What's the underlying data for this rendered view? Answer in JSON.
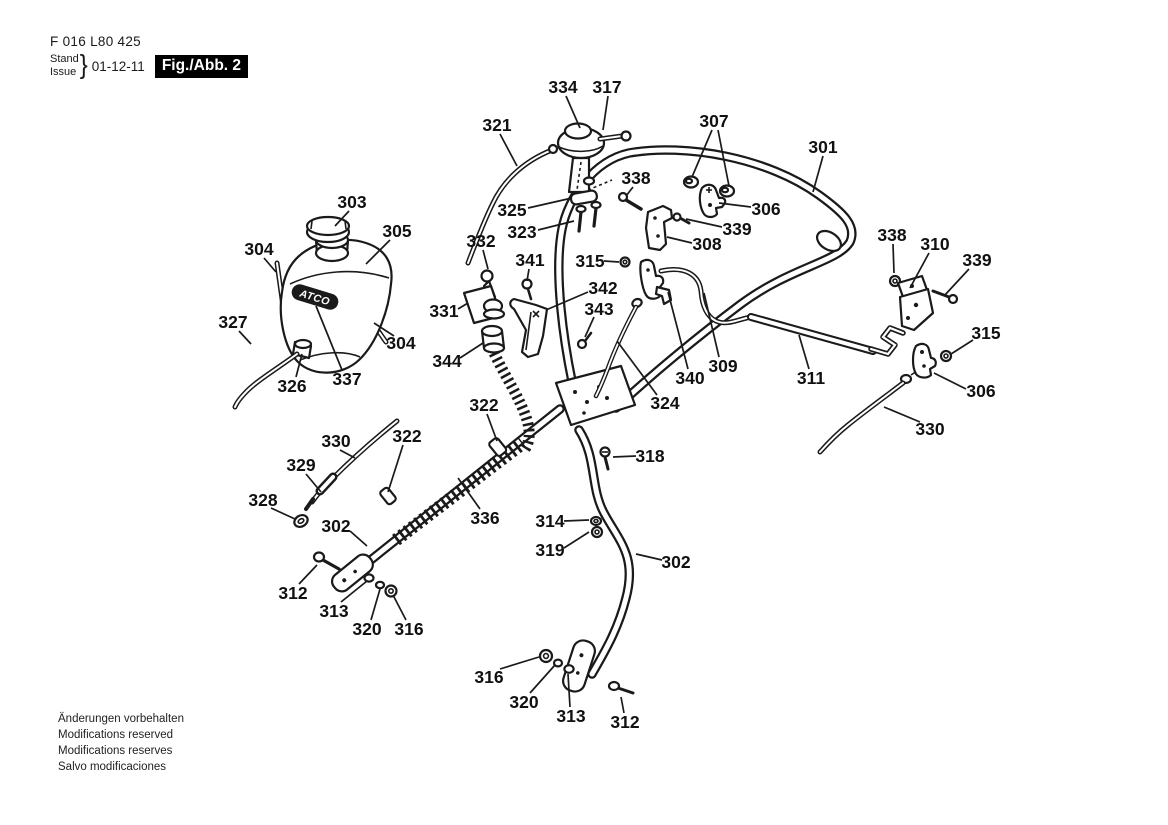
{
  "header": {
    "part_number": "F 016 L80 425",
    "stand_label": "Stand",
    "issue_label": "Issue",
    "brace": "}",
    "date": "01-12-11",
    "figure_label": "Fig./Abb. 2"
  },
  "footer": {
    "lines": [
      "Änderungen vorbehalten",
      "Modifications reserved",
      "Modifications reserves",
      "Salvo modificaciones"
    ]
  },
  "diagram": {
    "tank_logo": "ATCO",
    "ink_color": "#1a1a1a",
    "callouts": [
      {
        "text": "334",
        "x": 563,
        "y": 87,
        "leaders": [
          [
            566,
            96,
            580,
            128
          ]
        ]
      },
      {
        "text": "317",
        "x": 607,
        "y": 87,
        "leaders": [
          [
            608,
            96,
            603,
            130
          ]
        ]
      },
      {
        "text": "321",
        "x": 497,
        "y": 125,
        "leaders": [
          [
            500,
            134,
            517,
            166
          ]
        ]
      },
      {
        "text": "307",
        "x": 714,
        "y": 121,
        "leaders": [
          [
            712,
            130,
            692,
            177
          ],
          [
            718,
            130,
            729,
            186
          ]
        ]
      },
      {
        "text": "301",
        "x": 823,
        "y": 147,
        "leaders": [
          [
            823,
            156,
            813,
            192
          ]
        ]
      },
      {
        "text": "338",
        "x": 636,
        "y": 178,
        "leaders": [
          [
            633,
            187,
            626,
            196
          ]
        ]
      },
      {
        "text": "325",
        "x": 512,
        "y": 210,
        "leaders": [
          [
            528,
            208,
            572,
            198
          ]
        ]
      },
      {
        "text": "323",
        "x": 522,
        "y": 232,
        "leaders": [
          [
            538,
            230,
            574,
            221
          ]
        ]
      },
      {
        "text": "303",
        "x": 352,
        "y": 202,
        "leaders": [
          [
            349,
            211,
            335,
            226
          ]
        ]
      },
      {
        "text": "305",
        "x": 397,
        "y": 231,
        "leaders": [
          [
            390,
            240,
            366,
            264
          ]
        ]
      },
      {
        "text": "306",
        "x": 766,
        "y": 209,
        "leaders": [
          [
            751,
            207,
            719,
            203
          ]
        ]
      },
      {
        "text": "339",
        "x": 737,
        "y": 229,
        "leaders": [
          [
            722,
            227,
            686,
            219
          ]
        ]
      },
      {
        "text": "308",
        "x": 707,
        "y": 244,
        "leaders": [
          [
            692,
            243,
            667,
            237
          ]
        ]
      },
      {
        "text": "332",
        "x": 481,
        "y": 241,
        "leaders": [
          [
            483,
            250,
            488,
            269
          ]
        ]
      },
      {
        "text": "341",
        "x": 530,
        "y": 260,
        "leaders": [
          [
            529,
            269,
            527,
            281
          ]
        ]
      },
      {
        "text": "315",
        "x": 590,
        "y": 261,
        "leaders": [
          [
            604,
            261,
            619,
            262
          ]
        ]
      },
      {
        "text": "342",
        "x": 603,
        "y": 288,
        "leaders": [
          [
            588,
            292,
            546,
            310
          ]
        ]
      },
      {
        "text": "338",
        "x": 892,
        "y": 235,
        "leaders": [
          [
            893,
            244,
            894,
            273
          ]
        ]
      },
      {
        "text": "310",
        "x": 935,
        "y": 244,
        "leaders": [
          [
            929,
            253,
            910,
            288
          ]
        ]
      },
      {
        "text": "339",
        "x": 977,
        "y": 260,
        "leaders": [
          [
            969,
            269,
            944,
            296
          ]
        ]
      },
      {
        "text": "304",
        "x": 259,
        "y": 249,
        "leaders": [
          [
            264,
            258,
            276,
            272
          ]
        ]
      },
      {
        "text": "327",
        "x": 233,
        "y": 322,
        "leaders": [
          [
            239,
            331,
            251,
            344
          ]
        ]
      },
      {
        "text": "331",
        "x": 444,
        "y": 311,
        "leaders": [
          [
            458,
            309,
            468,
            303
          ]
        ]
      },
      {
        "text": "343",
        "x": 599,
        "y": 309,
        "leaders": [
          [
            594,
            317,
            585,
            337
          ]
        ]
      },
      {
        "text": "344",
        "x": 447,
        "y": 361,
        "leaders": [
          [
            460,
            358,
            483,
            343
          ]
        ]
      },
      {
        "text": "304",
        "x": 401,
        "y": 343,
        "leaders": [
          [
            394,
            336,
            374,
            323
          ]
        ]
      },
      {
        "text": "326",
        "x": 292,
        "y": 386,
        "leaders": [
          [
            296,
            377,
            302,
            354
          ]
        ]
      },
      {
        "text": "337",
        "x": 347,
        "y": 379,
        "leaders": [
          [
            342,
            370,
            316,
            306
          ]
        ]
      },
      {
        "text": "315",
        "x": 986,
        "y": 333,
        "leaders": [
          [
            973,
            340,
            951,
            354
          ]
        ]
      },
      {
        "text": "340",
        "x": 690,
        "y": 378,
        "leaders": [
          [
            688,
            369,
            668,
            292
          ]
        ]
      },
      {
        "text": "309",
        "x": 723,
        "y": 366,
        "leaders": [
          [
            719,
            357,
            704,
            293
          ]
        ]
      },
      {
        "text": "311",
        "x": 811,
        "y": 378,
        "leaders": [
          [
            809,
            369,
            799,
            335
          ]
        ]
      },
      {
        "text": "306",
        "x": 981,
        "y": 391,
        "leaders": [
          [
            966,
            389,
            934,
            373
          ]
        ]
      },
      {
        "text": "324",
        "x": 665,
        "y": 403,
        "leaders": [
          [
            657,
            395,
            617,
            341
          ]
        ]
      },
      {
        "text": "322",
        "x": 484,
        "y": 405,
        "leaders": [
          [
            487,
            414,
            497,
            441
          ]
        ]
      },
      {
        "text": "330",
        "x": 930,
        "y": 429,
        "leaders": [
          [
            920,
            422,
            884,
            407
          ]
        ]
      },
      {
        "text": "330",
        "x": 336,
        "y": 441,
        "leaders": [
          [
            340,
            450,
            355,
            458
          ]
        ]
      },
      {
        "text": "322",
        "x": 407,
        "y": 436,
        "leaders": [
          [
            403,
            445,
            388,
            492
          ]
        ]
      },
      {
        "text": "329",
        "x": 301,
        "y": 465,
        "leaders": [
          [
            306,
            474,
            321,
            492
          ]
        ]
      },
      {
        "text": "318",
        "x": 650,
        "y": 456,
        "leaders": [
          [
            636,
            456,
            613,
            457
          ]
        ]
      },
      {
        "text": "328",
        "x": 263,
        "y": 500,
        "leaders": [
          [
            271,
            508,
            295,
            519
          ]
        ]
      },
      {
        "text": "336",
        "x": 485,
        "y": 518,
        "leaders": [
          [
            480,
            509,
            458,
            478
          ]
        ]
      },
      {
        "text": "302",
        "x": 336,
        "y": 526,
        "leaders": [
          [
            350,
            531,
            367,
            546
          ]
        ]
      },
      {
        "text": "314",
        "x": 550,
        "y": 521,
        "leaders": [
          [
            564,
            521,
            589,
            520
          ]
        ]
      },
      {
        "text": "319",
        "x": 550,
        "y": 550,
        "leaders": [
          [
            564,
            548,
            589,
            532
          ]
        ]
      },
      {
        "text": "302",
        "x": 676,
        "y": 562,
        "leaders": [
          [
            662,
            560,
            636,
            554
          ]
        ]
      },
      {
        "text": "312",
        "x": 293,
        "y": 593,
        "leaders": [
          [
            299,
            584,
            317,
            565
          ]
        ]
      },
      {
        "text": "313",
        "x": 334,
        "y": 611,
        "leaders": [
          [
            341,
            602,
            367,
            581
          ]
        ]
      },
      {
        "text": "320",
        "x": 367,
        "y": 629,
        "leaders": [
          [
            371,
            620,
            380,
            589
          ]
        ]
      },
      {
        "text": "316",
        "x": 409,
        "y": 629,
        "leaders": [
          [
            406,
            620,
            393,
            595
          ]
        ]
      },
      {
        "text": "316",
        "x": 489,
        "y": 677,
        "leaders": [
          [
            500,
            669,
            539,
            657
          ]
        ]
      },
      {
        "text": "320",
        "x": 524,
        "y": 702,
        "leaders": [
          [
            530,
            693,
            555,
            665
          ]
        ]
      },
      {
        "text": "313",
        "x": 571,
        "y": 716,
        "leaders": [
          [
            570,
            707,
            568,
            674
          ]
        ]
      },
      {
        "text": "312",
        "x": 625,
        "y": 722,
        "leaders": [
          [
            624,
            713,
            621,
            697
          ]
        ]
      }
    ]
  }
}
